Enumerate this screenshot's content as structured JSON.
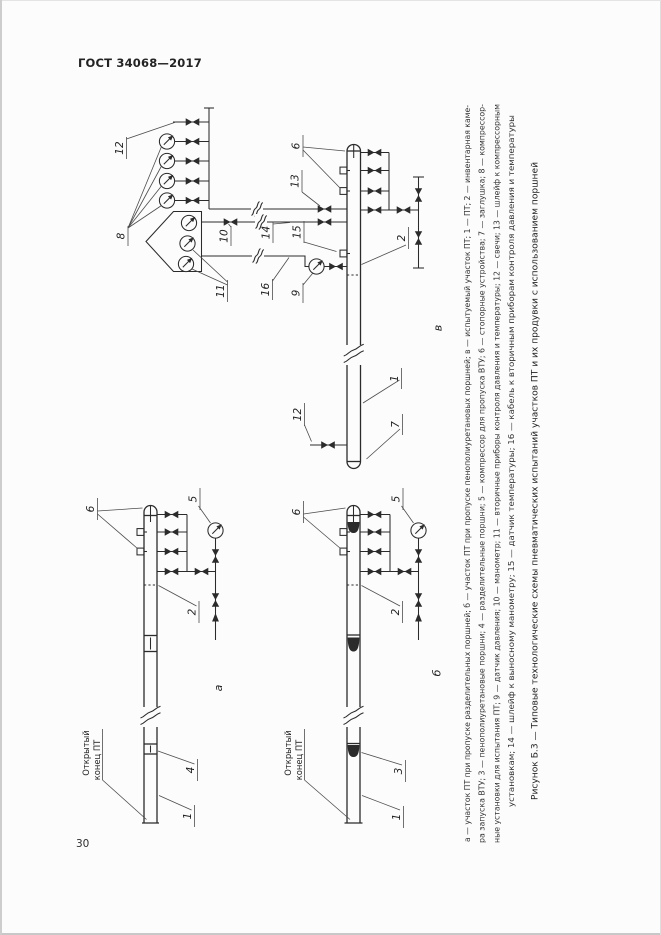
{
  "page": {
    "standard": "ГОСТ 34068—2017",
    "number": "30"
  },
  "figure": {
    "caption": "Рисунок Б.3 — Типовые технологические схемы пневматических испытаний участков ПТ и их продувки с использованием поршней",
    "legend": {
      "line1": "а — участок ПТ при пропуске разделительных поршней; б — участок ПТ при пропуске пенополиуретановых поршней; в — испытуемый участок ПТ; 1 — ПТ; 2 — инвентарная каме-",
      "line2": "ра запуска ВТУ; 3 — пенополиуретановые поршни; 4 — разделительные поршни; 5 — компрессор для пропуска ВТУ; 6 — стопорные устройства; 7 — заглушка; 8 — компрессор-",
      "line3": "ные установки для испытания ПТ; 9 — датчик давления; 10 — манометр; 11 — вторичные приборы контроля давления и температуры; 12 — свечи; 13 — шлейф к компрессорным",
      "line4": "установкам; 14 — шлейф к выносному манометру; 15 — датчик температуры; 16 — кабель к вторичным приборам контроля давления и температуры"
    },
    "sublabels": {
      "top": "в",
      "left": "а",
      "right": "б"
    },
    "open_end": {
      "line1": "Открытый",
      "line2": "конец ПТ"
    },
    "parts": {
      "p1": "1",
      "p2": "2",
      "p3": "3",
      "p4": "4",
      "p5": "5",
      "p6": "6",
      "p7": "7",
      "p8": "8",
      "p9": "9",
      "p10": "10",
      "p11": "11",
      "p12": "12",
      "p13": "13",
      "p14": "14",
      "p15": "15",
      "p16": "16"
    }
  },
  "colors": {
    "ink": "#2b2b2b",
    "paper": "#fcfcfc"
  }
}
